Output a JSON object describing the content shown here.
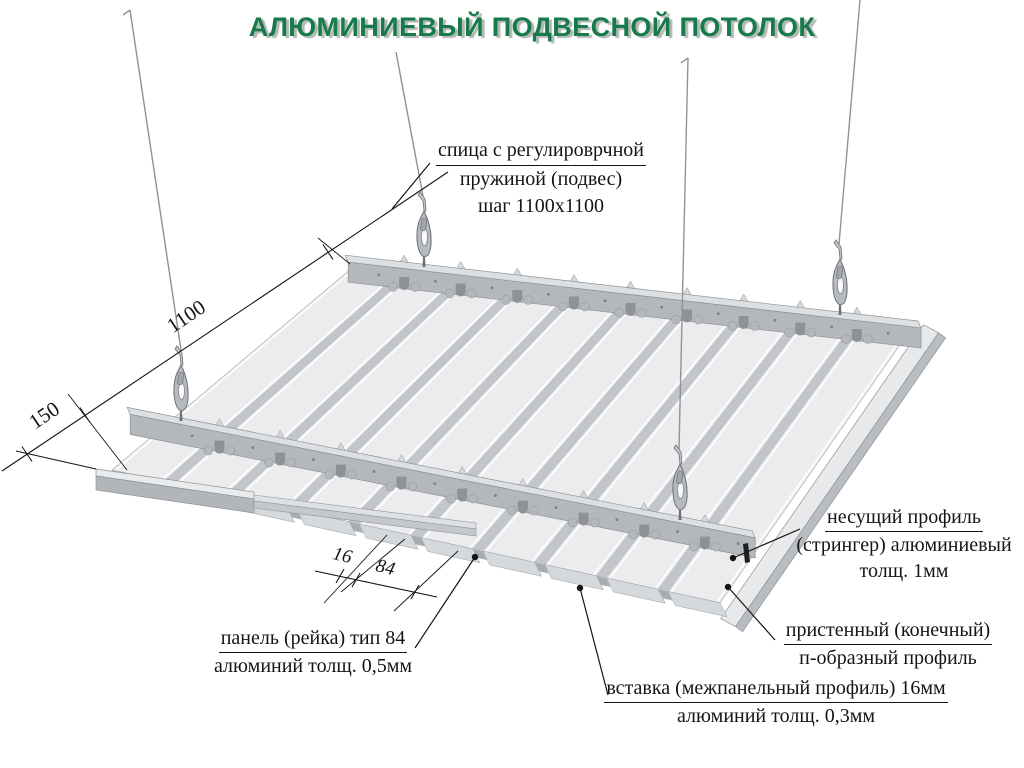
{
  "title": "АЛЮМИНИЕВЫЙ ПОДВЕСНОЙ ПОТОЛОК",
  "annotations": {
    "hanger": {
      "line1": "спица с регулироврчной",
      "line2": "пружиной (подвес)",
      "line3": "шаг 1100x1100"
    },
    "stringer": {
      "line1": "несущий профиль",
      "line2": "(стрингер) алюминиевый",
      "line3": "толщ. 1мм"
    },
    "wall_profile": {
      "line1": "пристенный (конечный)",
      "line2": "п-образный профиль"
    },
    "panel": {
      "line1": "панель (рейка) тип 84",
      "line2": "алюминий толщ. 0,5мм"
    },
    "insert": {
      "line1": "вставка (межпанельный профиль) 16мм",
      "line2": "алюминий толщ. 0,3мм"
    }
  },
  "dimensions": {
    "suspension_step": "1100",
    "wall_offset": "150",
    "insert_width": "16",
    "panel_width": "84"
  },
  "colors": {
    "title_green": "#177a4b",
    "panel_face": "#ececee",
    "panel_gap": "#c2c6ca",
    "panel_edge": "#a3a8ad",
    "ridge_white": "#ffffff",
    "end_face": "#d6d9dc",
    "end_face_gap": "#a9adb1",
    "metal_light": "#dde0e2",
    "metal_mid": "#b4b7bb",
    "slot_dark": "#8e9296",
    "rim_top": "#e7e9eb",
    "rim_face": "#b9bdc1",
    "bar_top": "#e9ebed",
    "bar_face": "#b2b6ba",
    "outline": "#8f9397",
    "wire_gray": "#8f9397",
    "line_black": "#141414"
  }
}
